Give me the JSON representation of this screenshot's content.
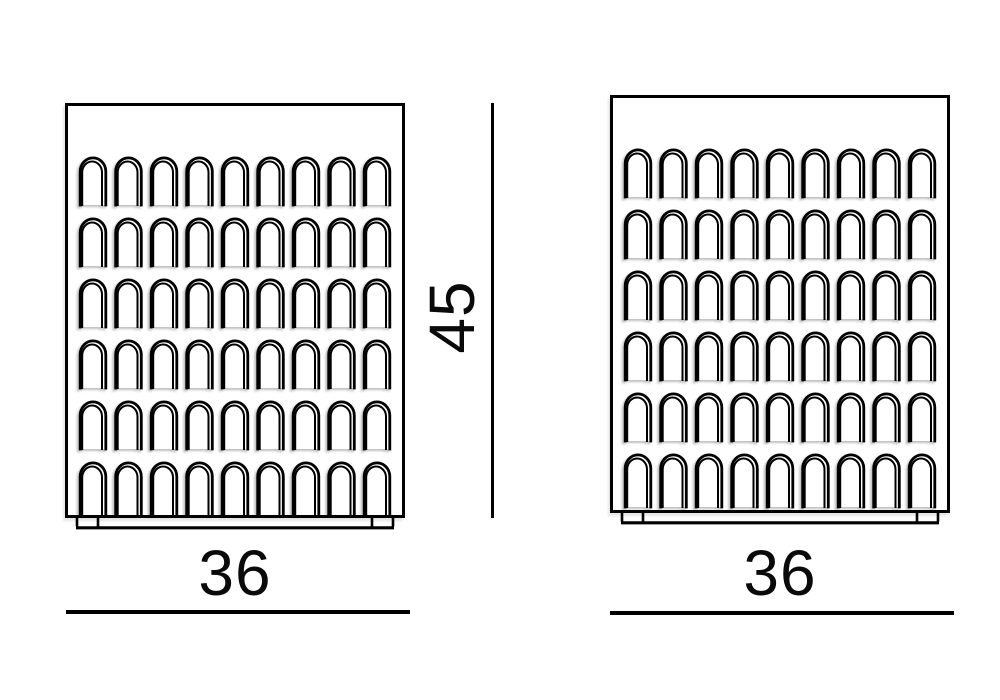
{
  "page": {
    "background_color": "#ffffff",
    "line_color": "#000000",
    "description": "Technical dimension drawing of two arch-patterned furniture units"
  },
  "views": {
    "front": {
      "width_dim": {
        "value": "36"
      },
      "pattern": {
        "motif": "arch",
        "rows": 6,
        "columns": 9
      }
    },
    "side": {
      "width_dim": {
        "value": "36"
      },
      "pattern": {
        "motif": "arch",
        "rows": 6,
        "columns": 9
      }
    },
    "height_dim": {
      "value": "45"
    }
  }
}
